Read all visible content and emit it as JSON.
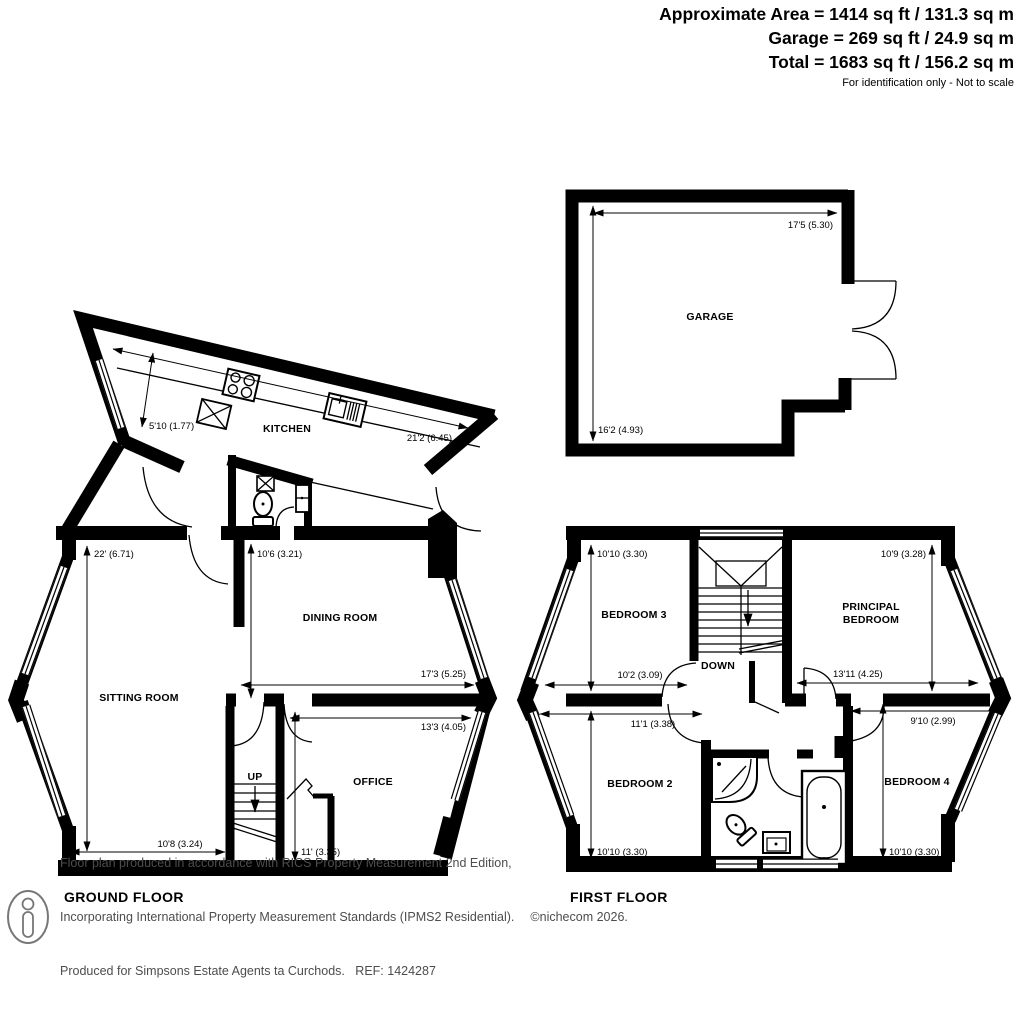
{
  "header": {
    "area_line": "Approximate Area = 1414 sq ft / 131.3 sq m",
    "garage_line": "Garage = 269 sq ft / 24.9 sq m",
    "total_line": "Total = 1683 sq ft / 156.2 sq m",
    "disclaimer": "For identification only - Not to scale"
  },
  "ground_floor": {
    "label": "GROUND FLOOR",
    "kitchen": {
      "name": "KITCHEN",
      "width": "5'10 (1.77)",
      "length": "21'2 (6.45)"
    },
    "sitting_room": {
      "name": "SITTING ROOM",
      "depth": "22' (6.71)",
      "width": "10'8 (3.24)"
    },
    "dining_room": {
      "name": "DINING ROOM",
      "depth": "10'6 (3.21)",
      "width": "17'3 (5.25)"
    },
    "office": {
      "name": "OFFICE",
      "width": "13'3 (4.05)",
      "depth": "11' (3.35)"
    },
    "stairs": "UP"
  },
  "garage": {
    "name": "GARAGE",
    "width": "17'5 (5.30)",
    "depth": "16'2 (4.93)"
  },
  "first_floor": {
    "label": "FIRST FLOOR",
    "bedroom3": {
      "name": "BEDROOM 3",
      "depth": "10'10 (3.30)",
      "width": "10'2 (3.09)"
    },
    "principal_bedroom": {
      "name_line1": "PRINCIPAL",
      "name_line2": "BEDROOM",
      "depth": "10'9 (3.28)",
      "width": "13'11 (4.25)"
    },
    "bedroom2": {
      "name": "BEDROOM 2",
      "width": "11'1 (3.38)",
      "depth": "10'10 (3.30)"
    },
    "bedroom4": {
      "name": "BEDROOM 4",
      "width": "9'10 (2.99)",
      "depth": "10'10 (3.30)"
    },
    "stairs": "DOWN"
  },
  "footer": {
    "line1": "Floor plan produced in accordance with RICS Property Measurement 2nd Edition,",
    "line2": "Incorporating International Property Measurement Standards (IPMS2 Residential).",
    "line3": "Produced for Simpsons Estate Agents ta Curchods.   REF: 1424287",
    "copyright": "©nichecom 2026."
  }
}
